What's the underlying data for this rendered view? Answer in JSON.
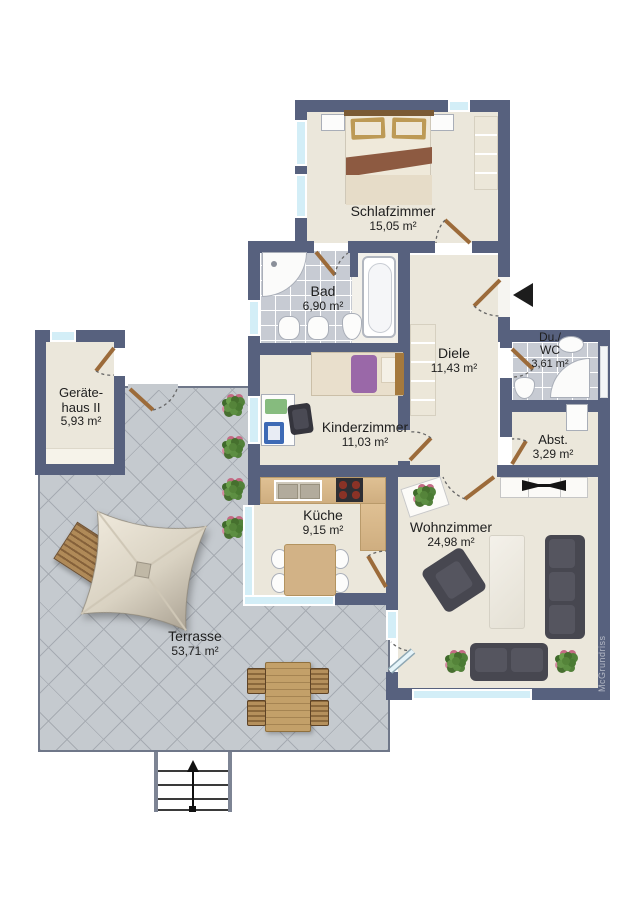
{
  "floorplan": {
    "title": "Wohnung Grundriss",
    "watermark": "McGrundriss",
    "rooms": {
      "schlafzimmer": {
        "name": "Schlafzimmer",
        "area": "15,05 m²"
      },
      "bad": {
        "name": "Bad",
        "area": "6,90 m²"
      },
      "diele": {
        "name": "Diele",
        "area": "11,43 m²"
      },
      "duwc": {
        "name": "Du./\nWC",
        "area": "3,61 m²"
      },
      "abst": {
        "name": "Abst.",
        "area": "3,29 m²"
      },
      "geraetehaus": {
        "name": "Geräte-\nhaus II",
        "area": "5,93 m²"
      },
      "kinderzimmer": {
        "name": "Kinderzimmer",
        "area": "11,03 m²"
      },
      "kueche": {
        "name": "Küche",
        "area": "9,15 m²"
      },
      "wohnzimmer": {
        "name": "Wohnzimmer",
        "area": "24,98 m²"
      },
      "terrasse": {
        "name": "Terrasse",
        "area": "53,71 m²"
      }
    },
    "icons": {
      "entrance_arrow": "left-arrow",
      "stairs_arrow": "up-arrow"
    },
    "colors": {
      "wall": "#57617e",
      "floor": "#ebe7db",
      "bath_tiles": "#c7cbd3",
      "terrace_tiles": "#c5cacf",
      "window_glass": "#d3eef7",
      "door_wood": "#9c6b3a",
      "kitchen_counter": "#d9b88c",
      "sofa": "#474750",
      "kids_blanket": "#9a68a8",
      "bed_blanket": "#8d5a41"
    }
  }
}
